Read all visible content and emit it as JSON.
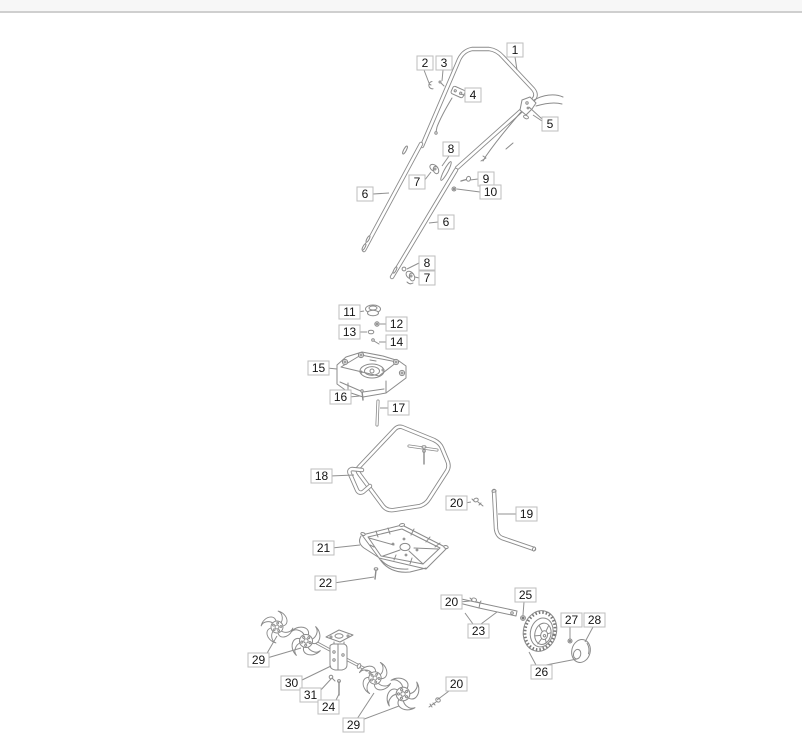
{
  "page": {
    "topbar": {
      "height": 13
    }
  },
  "colors": {
    "stroke": "#8b8b8b",
    "leader": "#909090",
    "label_border": "#bdbdbd",
    "label_text": "#151515",
    "label_bg": "#ffffff",
    "topbar_bg": "#f7f7f7",
    "topbar_border": "#cfcfcf",
    "tread": "#7a7a7a"
  },
  "diagram": {
    "type": "exploded-parts-diagram",
    "label_style": {
      "h": 14,
      "w_single": 16,
      "w_double": 21,
      "font_px": 12
    },
    "callouts": [
      {
        "n": "1",
        "x": 507,
        "y": 43,
        "leaders": [
          [
            515,
            57,
            517,
            70
          ]
        ]
      },
      {
        "n": "2",
        "x": 417,
        "y": 56,
        "leaders": [
          [
            424,
            70,
            429,
            83
          ]
        ]
      },
      {
        "n": "3",
        "x": 436,
        "y": 56,
        "leaders": [
          [
            443,
            70,
            442,
            81
          ]
        ]
      },
      {
        "n": "4",
        "x": 465,
        "y": 88,
        "leaders": [
          [
            465,
            95,
            459,
            94
          ]
        ]
      },
      {
        "n": "5",
        "x": 542,
        "y": 117,
        "leaders": [
          [
            542,
            121,
            533,
            115
          ],
          [
            542,
            119,
            529,
            107
          ]
        ]
      },
      {
        "n": "6",
        "x": 357,
        "y": 187,
        "leaders": [
          [
            373,
            194,
            389,
            193
          ]
        ]
      },
      {
        "n": "7",
        "x": 409,
        "y": 175,
        "leaders": [
          [
            424,
            181,
            431,
            172
          ]
        ]
      },
      {
        "n": "8",
        "x": 443,
        "y": 142,
        "leaders": [
          [
            449,
            156,
            442,
            166
          ]
        ]
      },
      {
        "n": "9",
        "x": 478,
        "y": 172,
        "leaders": [
          [
            478,
            179,
            470,
            180
          ]
        ]
      },
      {
        "n": "10",
        "x": 480,
        "y": 185,
        "leaders": [
          [
            480,
            192,
            457,
            189
          ]
        ]
      },
      {
        "n": "6",
        "x": 438,
        "y": 215,
        "leaders": [
          [
            438,
            222,
            429,
            223
          ]
        ]
      },
      {
        "n": "8",
        "x": 419,
        "y": 256,
        "leaders": [
          [
            419,
            263,
            407,
            269
          ]
        ]
      },
      {
        "n": "7",
        "x": 419,
        "y": 271,
        "leaders": [
          [
            419,
            278,
            415,
            277
          ]
        ]
      },
      {
        "n": "11",
        "x": 339,
        "y": 305,
        "leaders": [
          [
            358,
            312,
            364,
            311
          ]
        ]
      },
      {
        "n": "12",
        "x": 386,
        "y": 317,
        "leaders": [
          [
            386,
            324,
            380,
            324
          ]
        ]
      },
      {
        "n": "13",
        "x": 339,
        "y": 325,
        "leaders": [
          [
            358,
            332,
            367,
            332
          ]
        ]
      },
      {
        "n": "14",
        "x": 386,
        "y": 335,
        "leaders": [
          [
            386,
            342,
            379,
            342
          ]
        ]
      },
      {
        "n": "15",
        "x": 308,
        "y": 361,
        "leaders": [
          [
            327,
            368,
            337,
            369
          ]
        ]
      },
      {
        "n": "16",
        "x": 330,
        "y": 390,
        "leaders": [
          [
            349,
            397,
            360,
            396
          ]
        ]
      },
      {
        "n": "17",
        "x": 388,
        "y": 401,
        "leaders": [
          [
            388,
            408,
            380,
            408
          ]
        ]
      },
      {
        "n": "18",
        "x": 311,
        "y": 469,
        "leaders": [
          [
            330,
            476,
            354,
            475
          ]
        ]
      },
      {
        "n": "20",
        "x": 446,
        "y": 496,
        "leaders": [
          [
            465,
            503,
            471,
            502
          ]
        ]
      },
      {
        "n": "19",
        "x": 516,
        "y": 507,
        "leaders": [
          [
            516,
            514,
            498,
            514
          ]
        ]
      },
      {
        "n": "21",
        "x": 313,
        "y": 541,
        "leaders": [
          [
            332,
            548,
            360,
            545
          ]
        ]
      },
      {
        "n": "22",
        "x": 315,
        "y": 576,
        "leaders": [
          [
            334,
            583,
            374,
            577
          ]
        ]
      },
      {
        "n": "20",
        "x": 441,
        "y": 595,
        "leaders": [
          [
            460,
            602,
            470,
            601
          ]
        ]
      },
      {
        "n": "25",
        "x": 515,
        "y": 588,
        "leaders": [
          [
            524,
            602,
            523,
            615
          ]
        ]
      },
      {
        "n": "23",
        "x": 468,
        "y": 624,
        "leaders": [
          [
            473,
            624,
            465,
            613
          ],
          [
            481,
            624,
            497,
            612
          ]
        ]
      },
      {
        "n": "27",
        "x": 561,
        "y": 613,
        "leaders": [
          [
            570,
            627,
            570,
            639
          ]
        ]
      },
      {
        "n": "28",
        "x": 584,
        "y": 613,
        "leaders": [
          [
            593,
            627,
            585,
            642
          ]
        ]
      },
      {
        "n": "26",
        "x": 531,
        "y": 665,
        "leaders": [
          [
            536,
            665,
            529,
            652
          ],
          [
            546,
            665,
            577,
            659
          ]
        ]
      },
      {
        "n": "29",
        "x": 248,
        "y": 653,
        "leaders": [
          [
            266,
            655,
            277,
            636
          ],
          [
            267,
            658,
            301,
            648
          ]
        ]
      },
      {
        "n": "30",
        "x": 281,
        "y": 676,
        "leaders": [
          [
            300,
            681,
            331,
            666
          ]
        ]
      },
      {
        "n": "31",
        "x": 300,
        "y": 688,
        "leaders": [
          [
            319,
            692,
            331,
            679
          ]
        ]
      },
      {
        "n": "24",
        "x": 318,
        "y": 700,
        "leaders": [
          [
            335,
            702,
            339,
            694
          ]
        ]
      },
      {
        "n": "29",
        "x": 343,
        "y": 718,
        "leaders": [
          [
            357,
            719,
            374,
            693
          ],
          [
            359,
            721,
            399,
            706
          ]
        ]
      },
      {
        "n": "20",
        "x": 446,
        "y": 677,
        "leaders": [
          [
            449,
            691,
            437,
            700
          ]
        ]
      }
    ]
  }
}
